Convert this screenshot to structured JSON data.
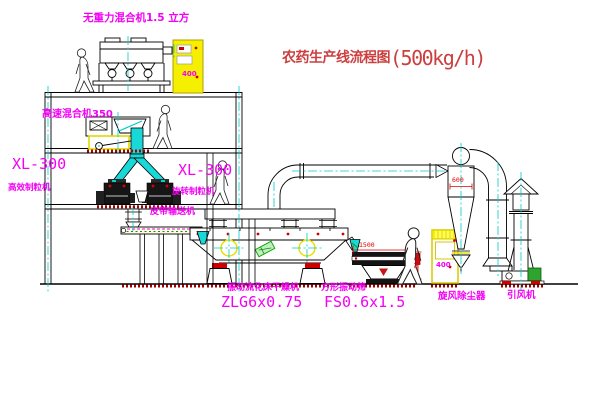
{
  "title": {
    "text": "农药生产线流程图",
    "capacity": "(500kg/h)"
  },
  "equipment_labels": {
    "gravity_mixer": "无重力混合机1.5 立方",
    "speed_mixer": "高速混合机350",
    "granulator_left": {
      "model": "XL-300",
      "name": "高效制粒机"
    },
    "granulator_mid": {
      "model": "XL-300",
      "name": "旋转制粒机"
    },
    "belt_conveyor": "皮带输送机",
    "dryer": {
      "name": "振动流化床干燥机",
      "model": "ZLG6x0.75"
    },
    "sieve": {
      "name": "方形振动筛",
      "model": "FS0.6x1.5"
    },
    "cyclone": "旋风除尘器",
    "fan": "引风机"
  },
  "dimensions": {
    "sieve_length": "1500",
    "sieve_height": "540",
    "cyclone_diameter": "600"
  },
  "cabinets": {
    "cabinet_a": "400",
    "cabinet_b": "400"
  },
  "colors": {
    "label_magenta": "#f400f4",
    "title_red": "#cc3f3f",
    "dimension_red": "#e00000",
    "equipment_yellow": "#f4f000",
    "centerline_cyan": "#00cccc",
    "chute_cyan": "#18d8d8",
    "hatch_red": "#a00000",
    "line_black": "#000000"
  }
}
